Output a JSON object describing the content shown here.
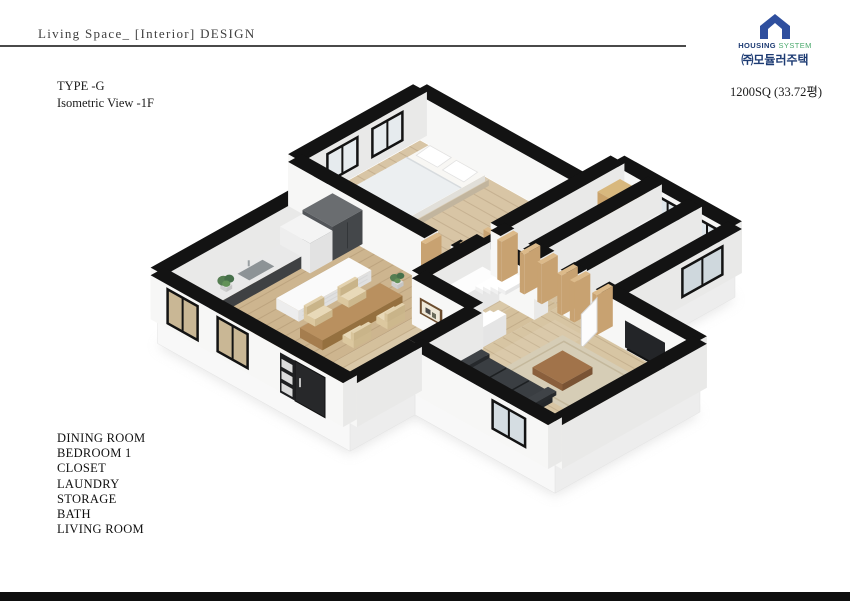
{
  "header": {
    "title": "Living Space_ [Interior] DESIGN"
  },
  "logo": {
    "housing": "HOUSING",
    "system": "SYSTEM",
    "company": "㈜모듈러주택"
  },
  "plan_info": {
    "type": "TYPE -G",
    "view": "Isometric View -1F",
    "area": "1200SQ (33.72평)"
  },
  "room_list": [
    "DINING ROOM",
    "BEDROOM 1",
    "CLOSET",
    "LAUNDRY",
    "STORAGE",
    "BATH",
    "LIVING ROOM"
  ],
  "palette": {
    "brand_blue": "#2f4f9e",
    "brand_navy": "#1d3b73",
    "brand_green": "#4aa96c",
    "wall_cap": "#131313",
    "wall_face": "#f7f7f6",
    "wall_side": "#e9e9e8",
    "floor_wood": "#d2bd98",
    "glass": "#d5dde2",
    "rug": "#d6cdb6",
    "sofa_dark": "#2d3134",
    "counter_dark": "#4c4e50",
    "table_wood": "#b9905f",
    "door_trim": "#dcba8a",
    "bottom_bar": "#0e0e0e"
  }
}
